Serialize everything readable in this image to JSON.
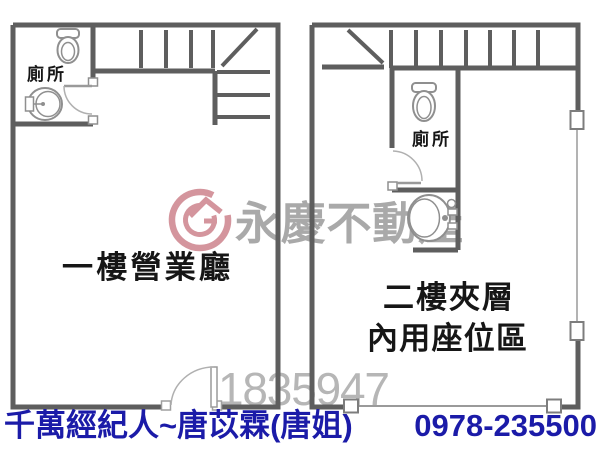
{
  "canvas": {
    "width": 600,
    "height": 451
  },
  "floor1": {
    "name_label": "一樓營業廳",
    "toilet_label": "廁所"
  },
  "floor2": {
    "name_label_line1": "二樓夾層",
    "name_label_line2": "內用座位區",
    "toilet_label": "廁所"
  },
  "watermark": {
    "brand_text": "永慶不動產",
    "listing_number": "1835947",
    "logo_color": "#d4959d",
    "brand_text_color": "#a9a9a9",
    "number_color": "#b6b6b6"
  },
  "footer": {
    "agent_text": "千萬經紀人~唐苡霖(唐姐)",
    "phone": "0978-235500",
    "text_color": "#1b1ba8"
  },
  "colors": {
    "wall": "#5e5e5e",
    "thin_line": "#9a9a9a",
    "fixture": "#8f8f8f",
    "label_text": "#161616",
    "background": "#ffffff"
  }
}
